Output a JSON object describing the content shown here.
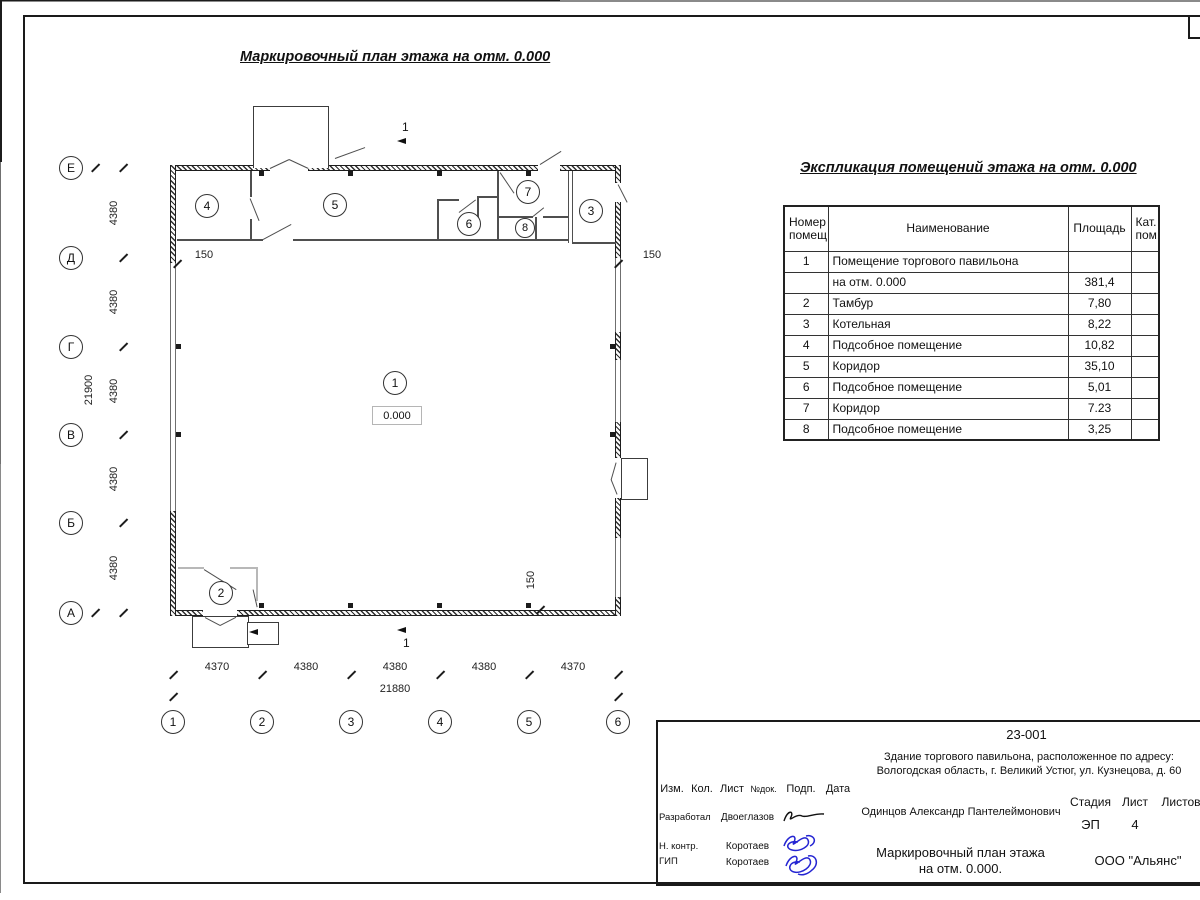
{
  "plan": {
    "title": "Маркировочный план этажа на отм. 0.000",
    "level_label": "0.000",
    "section_mark": "1",
    "axes_vertical": [
      "Е",
      "Д",
      "Г",
      "В",
      "Б",
      "А"
    ],
    "axes_horizontal": [
      "1",
      "2",
      "3",
      "4",
      "5",
      "6"
    ],
    "dims_left_segments": [
      "4380",
      "4380",
      "4380",
      "4380",
      "4380"
    ],
    "dim_left_total": "21900",
    "dims_bottom_segments": [
      "4370",
      "4380",
      "4380",
      "4380",
      "4370"
    ],
    "dim_bottom_total": "21880",
    "dim_wall_left": "150",
    "dim_wall_right": "150",
    "dim_wall_bottom": "150",
    "rooms": [
      "1",
      "2",
      "3",
      "4",
      "5",
      "6",
      "7",
      "8"
    ]
  },
  "explication": {
    "title": "Экспликация помещений этажа на отм. 0.000",
    "headers": {
      "number": "Номер\nпомещ.",
      "name": "Наименование",
      "area": "Площадь",
      "cat": "Кат.\nпом."
    },
    "rows": [
      {
        "num": "1",
        "name": "Помещение торгового павильона",
        "area": "",
        "cat": ""
      },
      {
        "num": "",
        "name": "на отм. 0.000",
        "area": "381,4",
        "cat": ""
      },
      {
        "num": "2",
        "name": "Тамбур",
        "area": "7,80",
        "cat": ""
      },
      {
        "num": "3",
        "name": "Котельная",
        "area": "8,22",
        "cat": ""
      },
      {
        "num": "4",
        "name": "Подсобное помещение",
        "area": "10,82",
        "cat": ""
      },
      {
        "num": "5",
        "name": "Коридор",
        "area": "35,10",
        "cat": ""
      },
      {
        "num": "6",
        "name": "Подсобное помещение",
        "area": "5,01",
        "cat": ""
      },
      {
        "num": "7",
        "name": "Коридор",
        "area": "7.23",
        "cat": ""
      },
      {
        "num": "8",
        "name": "Подсобное помещение",
        "area": "3,25",
        "cat": ""
      }
    ]
  },
  "titleblock": {
    "doc_number": "23-001",
    "object_line1": "Здание торгового павильона, расположенное по адресу:",
    "object_line2": "Вологодская область, г. Великий Устюг, ул. Кузнецова, д. 60",
    "col_izm": "Изм.",
    "col_kol": "Кол.",
    "col_list": "Лист",
    "col_ndok": "№док.",
    "col_podp": "Подп.",
    "col_data": "Дата",
    "row1_role": "Разработал",
    "row1_name": "Двоеглазов",
    "row2_role": "Н. контр.",
    "row2_name": "Коротаев",
    "row3_role": "ГИП",
    "row3_name": "Коротаев",
    "author": "Одинцов Александр Пантелеймонович",
    "stage_label": "Стадия",
    "sheet_label": "Лист",
    "sheets_label": "Листов",
    "stage": "ЭП",
    "sheet": "4",
    "drawing_title_line1": "Маркировочный план этажа",
    "drawing_title_line2": "на отм. 0.000.",
    "company": "ООО \"Альянс\""
  }
}
